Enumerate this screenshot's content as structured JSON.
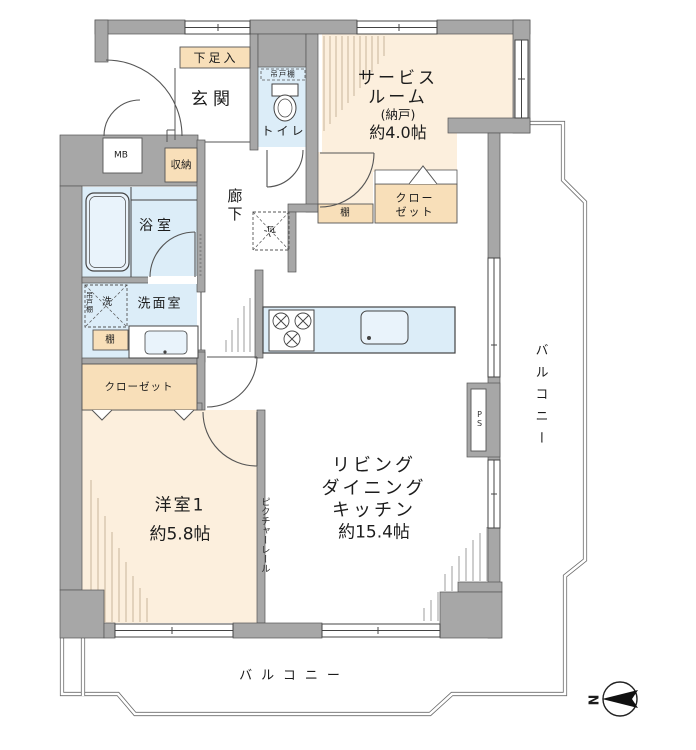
{
  "title": "apartment-floor-plan",
  "rooms": {
    "entrance": {
      "label": "玄関"
    },
    "shoe_box": {
      "label": "下足入"
    },
    "toilet": {
      "label": "トイレ",
      "hanging_shelf": "吊戸棚"
    },
    "service_room": {
      "line1": "サービス",
      "line2": "ルーム",
      "line3": "(納戸)",
      "line4": "約4.0帖"
    },
    "meter_box": {
      "label": "MB"
    },
    "storage": {
      "label": "収納"
    },
    "bathroom": {
      "label": "浴室"
    },
    "corridor": {
      "label": "廊下"
    },
    "fridge_space": {
      "label": "冷"
    },
    "washroom": {
      "label": "洗面室",
      "washer": "洗",
      "hanging_shelf": "吊戸棚",
      "shelf": "棚"
    },
    "kitchen_shelf": {
      "label": "棚"
    },
    "closet_service": {
      "line1": "クロー",
      "line2": "ゼット"
    },
    "closet_bedroom": {
      "label": "クローゼット"
    },
    "bedroom": {
      "line1": "洋室1",
      "line2": "約5.8帖"
    },
    "ldk": {
      "line1": "リビング",
      "line2": "ダイニング",
      "line3": "キッチン",
      "line4": "約15.4帖",
      "picture_rail": "ピクチャーレール"
    },
    "pipe_space": {
      "label": "PS"
    },
    "balcony_right": {
      "label": "バルコニー"
    },
    "balcony_bottom": {
      "label": "バルコニー"
    }
  },
  "compass": {
    "label": "N"
  },
  "colors": {
    "wall": "#a7a7a7",
    "room_beige": "#fcefdd",
    "cabinet_tan": "#f8dfb9",
    "wet_blue": "#dcedf8",
    "fixture_blue": "#e9f3fb",
    "line": "#4f4f4f",
    "hatch": "#c9b69c"
  }
}
